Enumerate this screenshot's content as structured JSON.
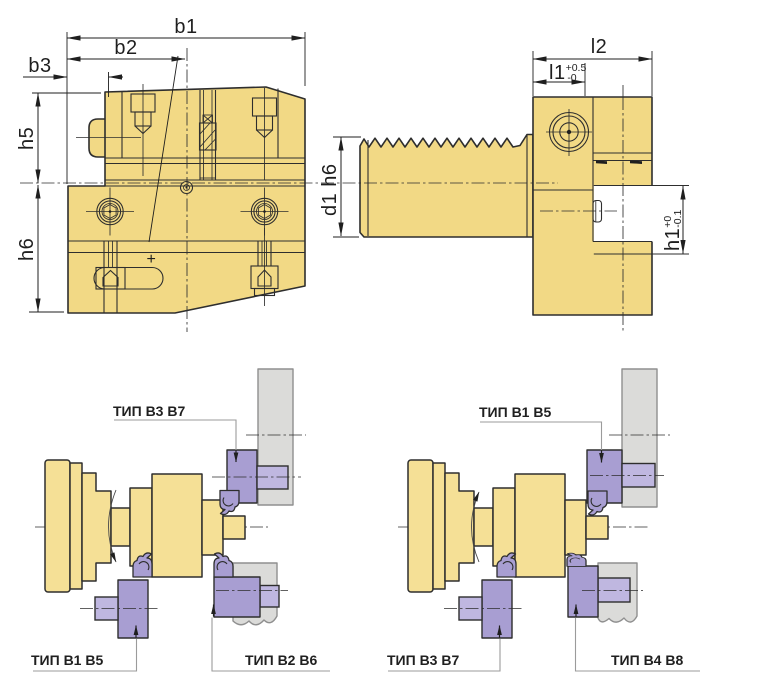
{
  "dims": {
    "b1": "b1",
    "b2": "b2",
    "b3": "b3",
    "h5": "h5",
    "h6": "h6",
    "d1_h6": "d1 h6",
    "l2": "l2",
    "l1_label": "l1",
    "l1_plus": "+0.5",
    "l1_minus": "-0",
    "h1_label": "h1",
    "h1_plus": "+0",
    "h1_minus": "-0.1",
    "plus_marker": "+"
  },
  "labels": {
    "a_top": "ТИП B3 B7",
    "a_bottom_left": "ТИП B1 B5",
    "a_bottom_right": "ТИП B2 B6",
    "b_top": "ТИП B1 B5",
    "b_bottom_left": "ТИП B3 B7",
    "b_bottom_right": "ТИП B4 B8"
  },
  "colors": {
    "body_yellow": "#F2D985",
    "body_yellow_light": "#F5E096",
    "outline": "#2E2E2E",
    "tool_dark": "#A89ED2",
    "tool_light": "#BFB7E0",
    "machine_grey": "#DBDBD9",
    "machine_edge": "#8F8F8F",
    "leader_grey": "#9B9B9B",
    "dim_color": "#1F1F1F"
  }
}
